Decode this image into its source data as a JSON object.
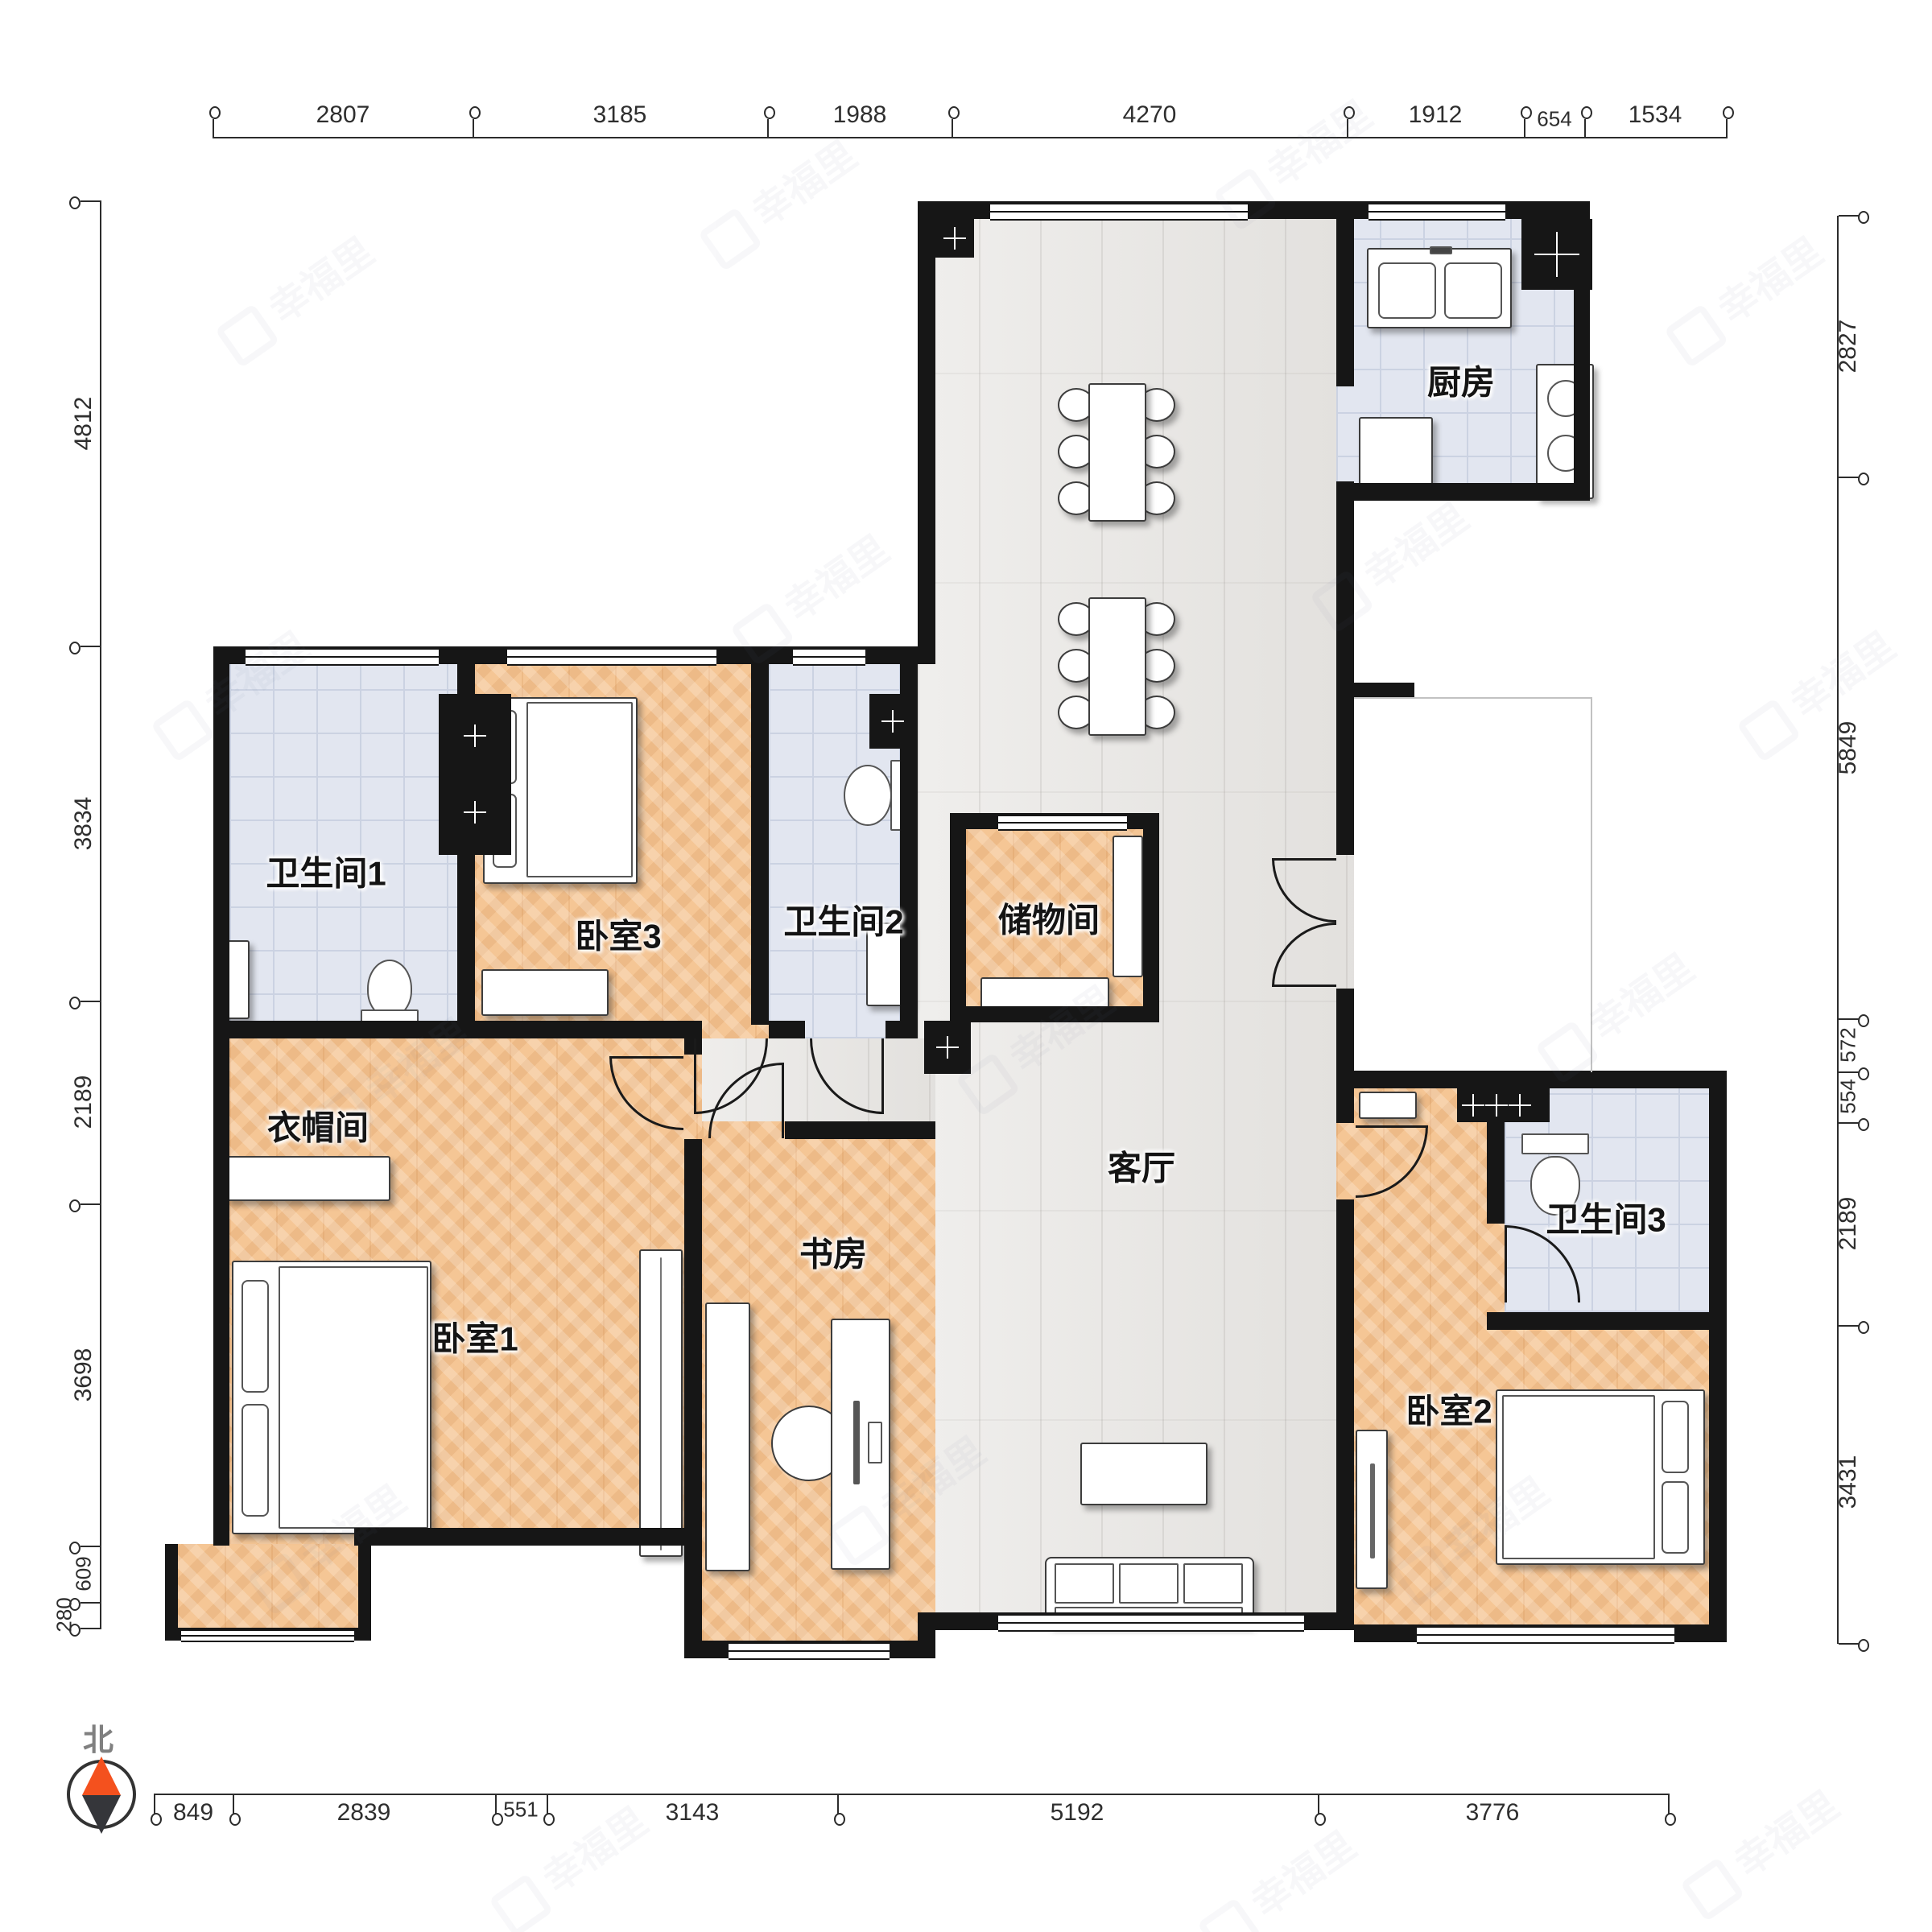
{
  "rooms": {
    "kitchen": "厨房",
    "bath1": "卫生间1",
    "bed3": "卧室3",
    "bath2": "卫生间2",
    "storage": "储物间",
    "living": "客厅",
    "cloak": "衣帽间",
    "bed1": "卧室1",
    "study": "书房",
    "bath3": "卫生间3",
    "bed2": "卧室2"
  },
  "compass": {
    "north": "北"
  },
  "watermark": {
    "text": "幸福里"
  },
  "dimensions": {
    "top": [
      "2807",
      "3185",
      "1988",
      "4270",
      "1912",
      "654",
      "1534"
    ],
    "bottom": [
      "849",
      "2839",
      "551",
      "3143",
      "5192",
      "3776"
    ],
    "left": [
      "4812",
      "3834",
      "2189",
      "3698",
      "609",
      "280"
    ],
    "right": [
      "2827",
      "5849",
      "572",
      "554",
      "2189",
      "3431"
    ]
  },
  "colors": {
    "wall": "#161616",
    "wood_floor": "#f5c695",
    "plank_floor": "#e7e5e2",
    "tile_floor": "#e2e6f0",
    "compass_orange": "#f4511e"
  }
}
